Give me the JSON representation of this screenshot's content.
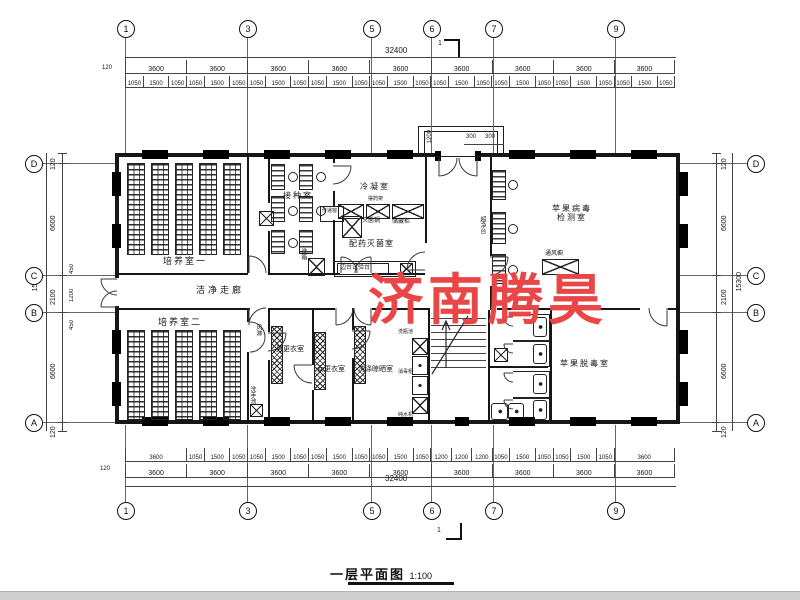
{
  "title": {
    "text": "一层平面图",
    "scale": "1:100"
  },
  "watermark": {
    "text": "济南腾昊",
    "color": "#e94747"
  },
  "grid": {
    "top": [
      "1",
      "3",
      "5",
      "6",
      "7",
      "9"
    ],
    "side": [
      "D",
      "C",
      "B",
      "A"
    ]
  },
  "section_mark": "1",
  "dims": {
    "top": {
      "overall": "32400",
      "edge": "120",
      "bays": [
        "3600",
        "3600",
        "3600",
        "3600",
        "3600",
        "3600",
        "3600",
        "3600",
        "3600"
      ],
      "sub": [
        "1050",
        "1500",
        "1050",
        "1050",
        "1500",
        "1050",
        "1050",
        "1500",
        "1050",
        "1050",
        "1500",
        "1050",
        "1050",
        "1500",
        "1050",
        "1050",
        "1500",
        "1050",
        "1050",
        "1500",
        "1050",
        "1050",
        "1500",
        "1050",
        "1050",
        "1500",
        "1050"
      ]
    },
    "bottom": {
      "overall": "32400",
      "edge": "120",
      "bays": [
        "3600",
        "3600",
        "3600",
        "3600",
        "3600",
        "3600",
        "3600",
        "3600",
        "3600"
      ],
      "detail": [
        "3600",
        "1050",
        "1500",
        "1050",
        "1050",
        "1500",
        "1050",
        "1050",
        "1500",
        "1050",
        "1050",
        "1500",
        "1050",
        "1200",
        "1200",
        "1200",
        "1050",
        "1500",
        "1050",
        "1050",
        "1500",
        "1050",
        "3600"
      ]
    },
    "left": {
      "overall": "15300",
      "main": [
        "120",
        "6600",
        "2100",
        "6600",
        "120"
      ],
      "extra": [
        "450",
        "1200",
        "450"
      ]
    },
    "right": {
      "overall": "15300",
      "main": [
        "120",
        "6600",
        "2100",
        "6600",
        "120"
      ]
    },
    "entrance": {
      "depth": "1200",
      "left": "300",
      "right": "300"
    }
  },
  "rooms": {
    "culture1": "培养室一",
    "inoculation": "接种室",
    "condensation": "冷凝室",
    "dispensing": "配药灭菌室",
    "virus_test_line1": "苹果病毒",
    "virus_test_line2": "检测室",
    "corridor": "洁净走廊",
    "culture2": "培养室二",
    "men_changing": "男更衣室",
    "women_changing": "女更衣室",
    "washing": "洗涤晾晒室",
    "detox": "苹果脱毒室"
  },
  "equipment": {
    "pass_window": "传递窗",
    "wash_box": "洗箱",
    "sterilizer": "灭菌锅",
    "storage_cabinet": "储藏柜",
    "med_rack": "摆药架",
    "side_bench": "边台试验台",
    "clean_bench": "超净台",
    "fume_hood": "通风橱",
    "air_shower": "风淋",
    "bottle_sink": "洗瓶池",
    "disinfect_cabinet": "消毒柜",
    "pure_water": "纯水机",
    "hand_sink": "洗手池"
  }
}
